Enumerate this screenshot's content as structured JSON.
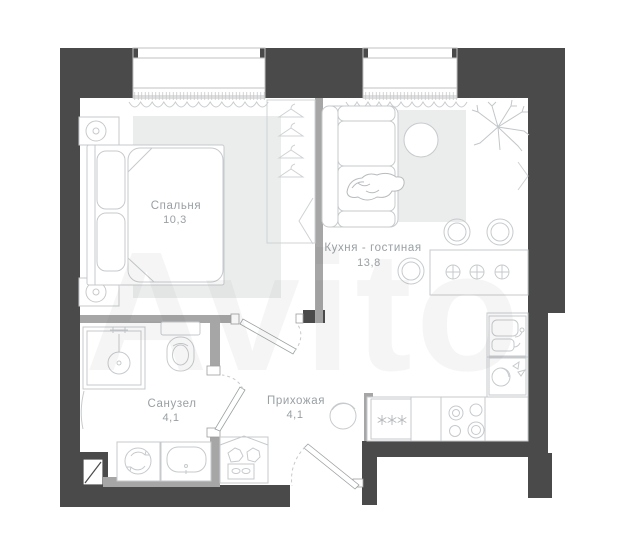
{
  "watermark": {
    "text": "Avito"
  },
  "rooms": {
    "bedroom": {
      "name": "Спальня",
      "area": "10,3"
    },
    "kitchen_living": {
      "name": "Кухня - гостиная",
      "area": "13,8"
    },
    "bathroom": {
      "name": "Санузел",
      "area": "4,1"
    },
    "hallway": {
      "name": "Прихожая",
      "area": "4,1"
    }
  },
  "colors": {
    "exterior_wall": "#4a4a4a",
    "partition_wall": "#a6a6a6",
    "furniture_line": "#c6cacd",
    "rug": "#ebecec",
    "label": "#99a0a4",
    "background": "#ffffff"
  },
  "icons": {
    "fridge_symbol": "three-asterisks",
    "wardrobe_symbol": "clothes-hangers",
    "door_symbol": "leaf-with-dashed-swing-arc"
  }
}
